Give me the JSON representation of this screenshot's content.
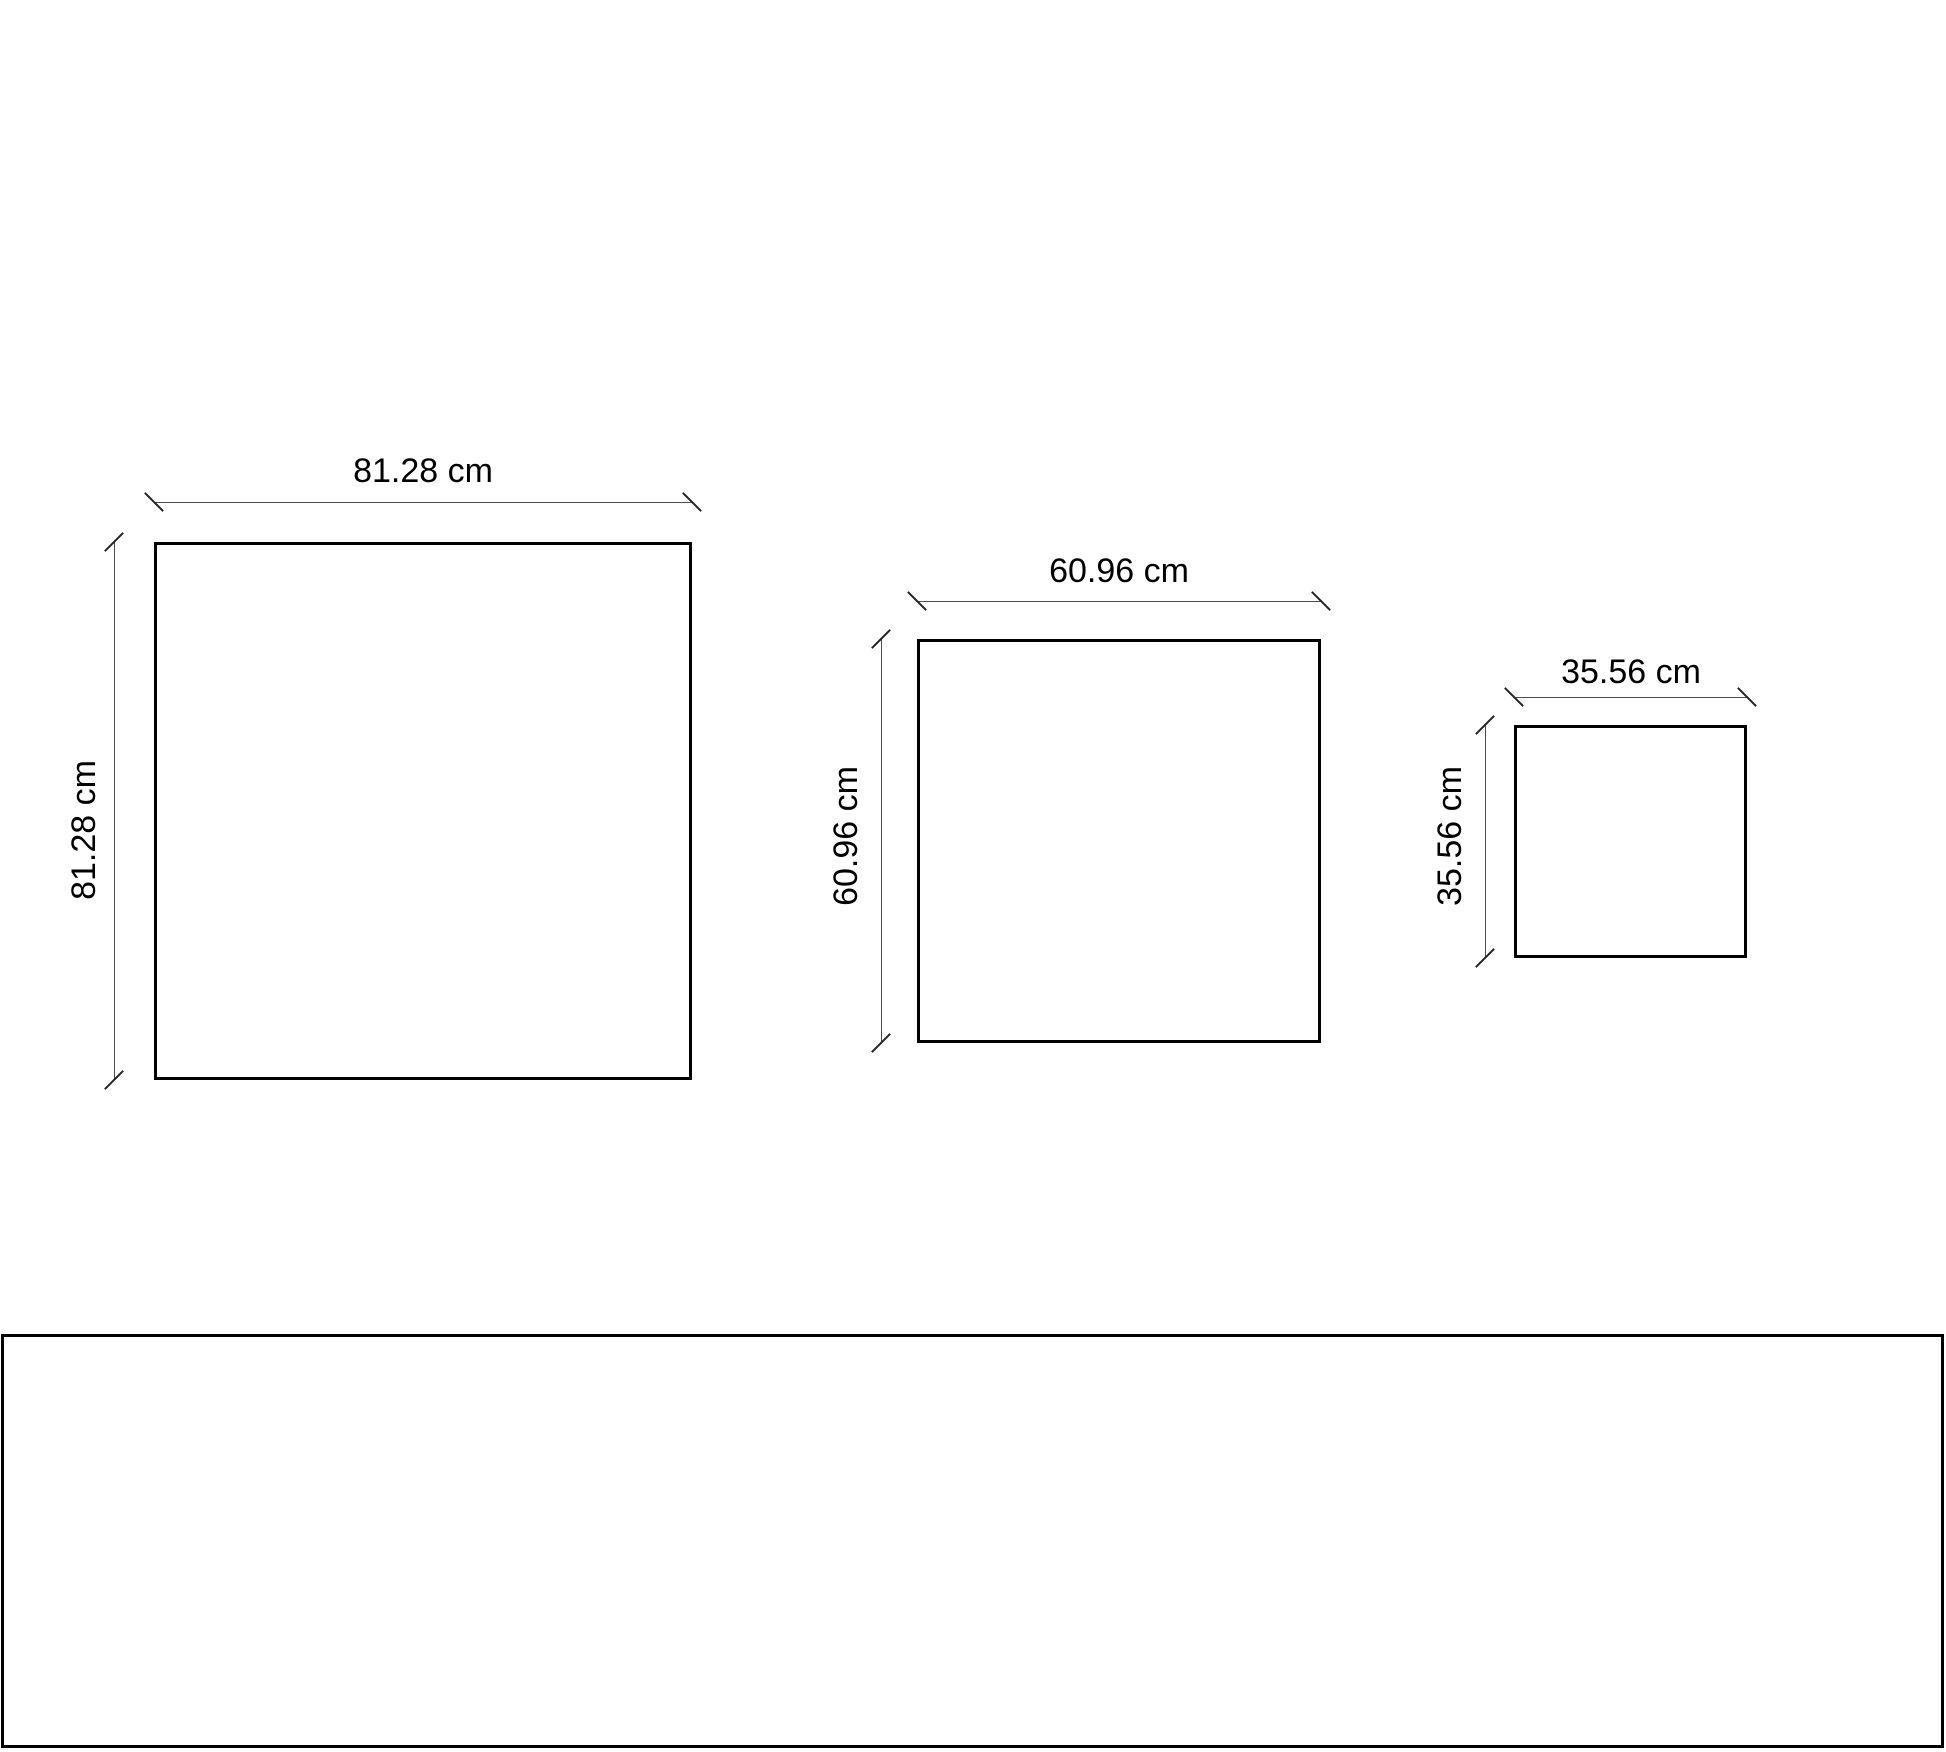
{
  "diagram": {
    "unit": "cm",
    "squares": [
      {
        "name": "square-1",
        "size_cm": 81.28,
        "width_label": "81.28 cm",
        "height_label": "81.28 cm"
      },
      {
        "name": "square-2",
        "size_cm": 60.96,
        "width_label": "60.96 cm",
        "height_label": "60.96 cm"
      },
      {
        "name": "square-3",
        "size_cm": 35.56,
        "width_label": "35.56 cm",
        "height_label": "35.56 cm"
      }
    ],
    "bottom_panel": {
      "content": ""
    },
    "colors": {
      "background": "#ffffff",
      "shape_border": "#000000",
      "dimension_line": "#4d4d4d",
      "text": "#000000"
    }
  }
}
